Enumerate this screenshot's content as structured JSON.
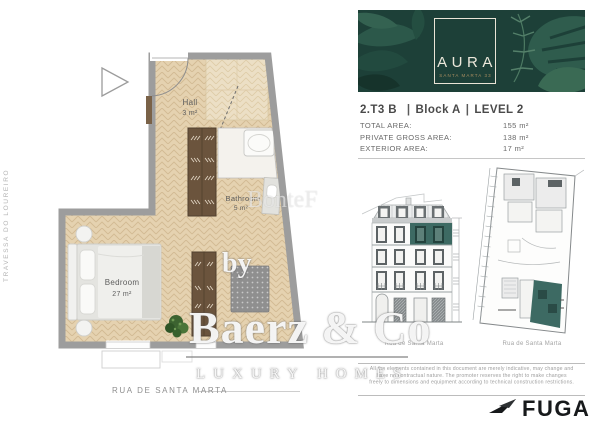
{
  "floor_plan": {
    "street_bottom": "RUA DE SANTA MARTA",
    "street_left": "TRAVESSA DO LOUREIRO",
    "rooms": [
      {
        "name": "Hall",
        "area": "3 m²"
      },
      {
        "name": "Bathroom",
        "area": "5 m²"
      },
      {
        "name": "Bedroom",
        "area": "27 m²"
      }
    ]
  },
  "watermark": {
    "prefix": "by",
    "brand": "Baerz & Co",
    "tagline": "LUXURY HOMES",
    "faint": "BonteF"
  },
  "brand_card": {
    "logo": "AURA",
    "logo_subtitle": "SANTA MARTA 33"
  },
  "unit_header": {
    "unit": "2.T3 B",
    "separator": "|",
    "block": "Block A",
    "level": "LEVEL 2"
  },
  "area_table": {
    "rows": [
      {
        "label": "TOTAL AREA:",
        "value": "155 m²"
      },
      {
        "label": "PRIVATE GROSS AREA:",
        "value": "138 m²"
      },
      {
        "label": "EXTERIOR AREA:",
        "value": "17 m²"
      }
    ]
  },
  "drawings": {
    "elevation_caption": "Rua de Santa Marta",
    "siteplan_caption": "Rua de Santa Marta"
  },
  "disclaimer": {
    "lines": [
      "All the elements contained in this document are merely indicative, may change and",
      "have no contractual nature. The promoter reserves the right to make changes",
      "freely to dimensions and equipment according to technical construction restrictions."
    ]
  },
  "footer": {
    "architect_logo": "FUGA"
  },
  "colors": {
    "card_green": "#1d4038",
    "accent_teal": "#3d6a63",
    "floor_beige": "#e5d2b0",
    "wall_gray": "#9d9d9d"
  }
}
